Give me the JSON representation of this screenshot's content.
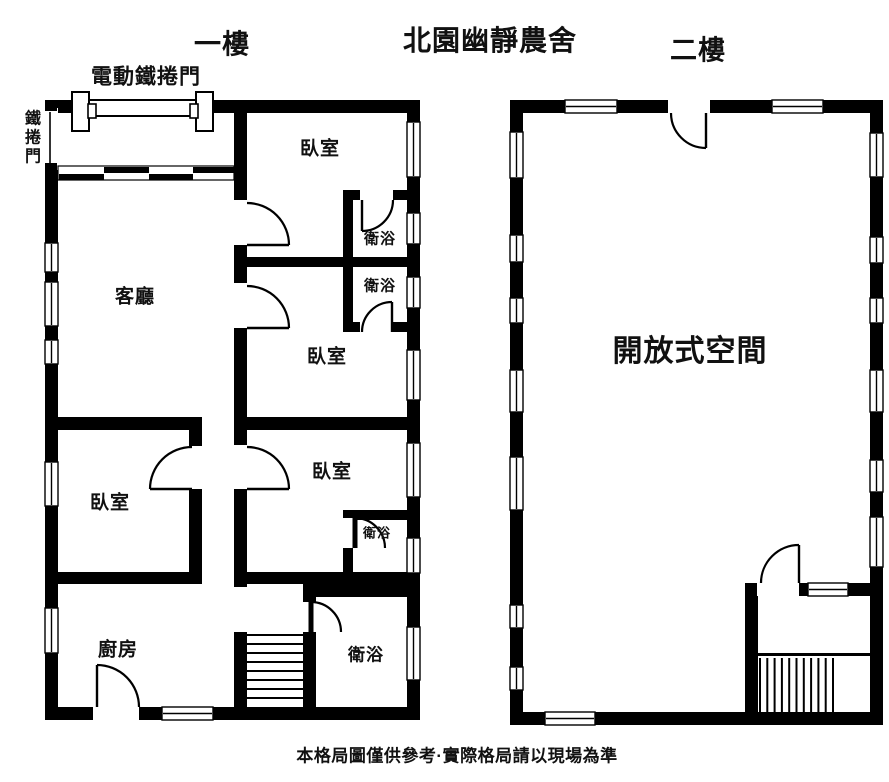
{
  "page": {
    "main_title": "北園幽靜農舍",
    "disclaimer": "本格局圖僅供參考·實際格局請以現場為準",
    "colors": {
      "wall": "#000000",
      "text": "#111111",
      "bg": "#ffffff"
    }
  },
  "floor1": {
    "title": "一樓",
    "garage_door_label": "電動鐵捲門",
    "side_door_label": "鐵捲門",
    "rooms": [
      {
        "name": "living-room",
        "label": "客廳",
        "x": 135,
        "y": 297,
        "fs": 19
      },
      {
        "name": "bedroom-1",
        "label": "臥室",
        "x": 320,
        "y": 149,
        "fs": 19
      },
      {
        "name": "bathroom-1",
        "label": "衛浴",
        "x": 380,
        "y": 239,
        "fs": 15
      },
      {
        "name": "bathroom-2",
        "label": "衛浴",
        "x": 380,
        "y": 286,
        "fs": 15
      },
      {
        "name": "bedroom-2",
        "label": "臥室",
        "x": 327,
        "y": 357,
        "fs": 19
      },
      {
        "name": "bedroom-3",
        "label": "臥室",
        "x": 332,
        "y": 472,
        "fs": 19
      },
      {
        "name": "bathroom-3",
        "label": "衛浴",
        "x": 377,
        "y": 533,
        "fs": 13
      },
      {
        "name": "bedroom-4",
        "label": "臥室",
        "x": 110,
        "y": 503,
        "fs": 19
      },
      {
        "name": "kitchen",
        "label": "廚房",
        "x": 118,
        "y": 650,
        "fs": 19
      },
      {
        "name": "bathroom-4",
        "label": "衛浴",
        "x": 366,
        "y": 655,
        "fs": 17
      }
    ],
    "walls": [
      [
        45,
        100,
        30,
        13
      ],
      [
        213,
        100,
        207,
        13
      ],
      [
        45,
        100,
        13,
        620
      ],
      [
        407,
        100,
        13,
        620
      ],
      [
        45,
        707,
        375,
        13
      ],
      [
        234,
        113,
        13,
        474
      ],
      [
        234,
        632,
        13,
        88
      ],
      [
        234,
        257,
        186,
        10
      ],
      [
        343,
        190,
        64,
        10
      ],
      [
        343,
        190,
        10,
        142
      ],
      [
        343,
        322,
        64,
        10
      ],
      [
        234,
        417,
        186,
        13
      ],
      [
        343,
        510,
        64,
        10
      ],
      [
        343,
        510,
        10,
        74
      ],
      [
        234,
        572,
        186,
        12
      ],
      [
        58,
        417,
        144,
        13
      ],
      [
        189,
        417,
        13,
        167
      ],
      [
        58,
        572,
        144,
        12
      ],
      [
        303,
        584,
        117,
        13
      ],
      [
        303,
        584,
        13,
        136
      ]
    ],
    "gaps": [
      [
        45,
        108,
        13,
        62
      ],
      [
        234,
        200,
        13,
        45
      ],
      [
        234,
        283,
        13,
        45
      ],
      [
        234,
        445,
        13,
        44
      ],
      [
        189,
        446,
        13,
        43
      ],
      [
        360,
        190,
        33,
        10
      ],
      [
        360,
        322,
        33,
        10
      ],
      [
        343,
        518,
        10,
        30
      ],
      [
        303,
        602,
        13,
        30
      ],
      [
        93,
        707,
        46,
        13
      ]
    ],
    "windows": [
      [
        45,
        243,
        13,
        29
      ],
      [
        45,
        282,
        13,
        44
      ],
      [
        45,
        340,
        13,
        24
      ],
      [
        45,
        462,
        13,
        44
      ],
      [
        45,
        608,
        13,
        45
      ],
      [
        407,
        122,
        13,
        55
      ],
      [
        407,
        213,
        13,
        31
      ],
      [
        407,
        277,
        13,
        31
      ],
      [
        407,
        350,
        13,
        50
      ],
      [
        407,
        443,
        13,
        54
      ],
      [
        407,
        538,
        13,
        35
      ],
      [
        407,
        627,
        13,
        53
      ],
      [
        162,
        707,
        51,
        13
      ]
    ],
    "doors": [
      {
        "arc": "M247 203 A42 42 0 0 1 289 245",
        "leaf": [
          247,
          245,
          289,
          245
        ]
      },
      {
        "arc": "M247 286 A42 42 0 0 1 289 328",
        "leaf": [
          247,
          328,
          289,
          328
        ]
      },
      {
        "arc": "M247 447 A42 42 0 0 1 289 489",
        "leaf": [
          247,
          489,
          289,
          489
        ]
      },
      {
        "arc": "M192 447 A42 42 0 0 0 150 489",
        "leaf": [
          192,
          489,
          150,
          489
        ]
      },
      {
        "arc": "M97 665 A42 42 0 0 1 139 707",
        "leaf": [
          97,
          707,
          97,
          665
        ]
      },
      {
        "arc": "M362 231 A31 31 0 0 0 393 200",
        "leaf": [
          362,
          200,
          362,
          231
        ]
      },
      {
        "arc": "M392 302 A30 30 0 0 0 362 332",
        "leaf": [
          392,
          332,
          392,
          302
        ]
      },
      {
        "arc": "M355 518 A30 30 0 0 1 385 548",
        "leaf": [
          355,
          518,
          355,
          548
        ],
        "lw": 5
      },
      {
        "arc": "M311 602 A30 30 0 0 1 341 632",
        "leaf": [
          311,
          602,
          311,
          632
        ],
        "lw": 5
      }
    ],
    "stairs": {
      "dir": "h",
      "start": 635,
      "step": 9,
      "count": 8,
      "from": 247,
      "len": 56
    },
    "garage": {
      "bar": [
        82,
        100,
        122,
        16
      ],
      "brackets": [
        [
          72,
          92,
          17,
          39
        ],
        [
          196,
          92,
          17,
          39
        ]
      ],
      "tabs": [
        [
          88,
          104,
          8,
          14
        ],
        [
          190,
          104,
          8,
          14
        ]
      ]
    },
    "side_door": {
      "line": [
        50,
        112,
        50,
        166
      ],
      "caps": [
        [
          45,
          104,
          12,
          7
        ],
        [
          45,
          163,
          12,
          7
        ]
      ]
    },
    "shutter": {
      "outline": [
        58,
        166,
        176,
        14
      ],
      "bars": [
        [
          59,
          174,
          45,
          6
        ],
        [
          104,
          167,
          45,
          6
        ],
        [
          149,
          174,
          44,
          6
        ],
        [
          193,
          167,
          41,
          6
        ]
      ]
    }
  },
  "floor2": {
    "title": "二樓",
    "rooms": [
      {
        "name": "open-space",
        "label": "開放式空間",
        "x": 690,
        "y": 352,
        "fs": 30
      }
    ],
    "walls": [
      [
        510,
        100,
        373,
        13
      ],
      [
        510,
        100,
        13,
        625
      ],
      [
        870,
        100,
        13,
        625
      ],
      [
        510,
        712,
        373,
        13
      ],
      [
        745,
        583,
        138,
        13
      ],
      [
        745,
        583,
        13,
        142
      ]
    ],
    "gaps": [
      [
        668,
        100,
        42,
        13
      ],
      [
        757,
        583,
        42,
        13
      ]
    ],
    "windows": [
      [
        565,
        100,
        52,
        13
      ],
      [
        772,
        100,
        51,
        13
      ],
      [
        510,
        132,
        13,
        46
      ],
      [
        510,
        235,
        13,
        27
      ],
      [
        510,
        298,
        13,
        25
      ],
      [
        510,
        370,
        13,
        42
      ],
      [
        510,
        457,
        13,
        53
      ],
      [
        510,
        605,
        13,
        23
      ],
      [
        510,
        667,
        13,
        23
      ],
      [
        870,
        133,
        13,
        44
      ],
      [
        870,
        237,
        13,
        26
      ],
      [
        870,
        298,
        13,
        25
      ],
      [
        870,
        370,
        13,
        42
      ],
      [
        870,
        460,
        13,
        32
      ],
      [
        870,
        517,
        13,
        50
      ],
      [
        545,
        712,
        50,
        13
      ],
      [
        808,
        583,
        40,
        13
      ]
    ],
    "doors": [
      {
        "arc": "M706 148 A35 35 0 0 1 671 113",
        "leaf": [
          706,
          113,
          706,
          148
        ]
      },
      {
        "arc": "M799 545 A38 38 0 0 0 761 583",
        "leaf": [
          799,
          583,
          799,
          545
        ]
      }
    ],
    "stairs": {
      "dir": "v",
      "start": 760,
      "step": 7.3,
      "count": 11,
      "from": 658,
      "len": 54
    },
    "landing_line": [
      755,
      653,
      115,
      3
    ]
  }
}
